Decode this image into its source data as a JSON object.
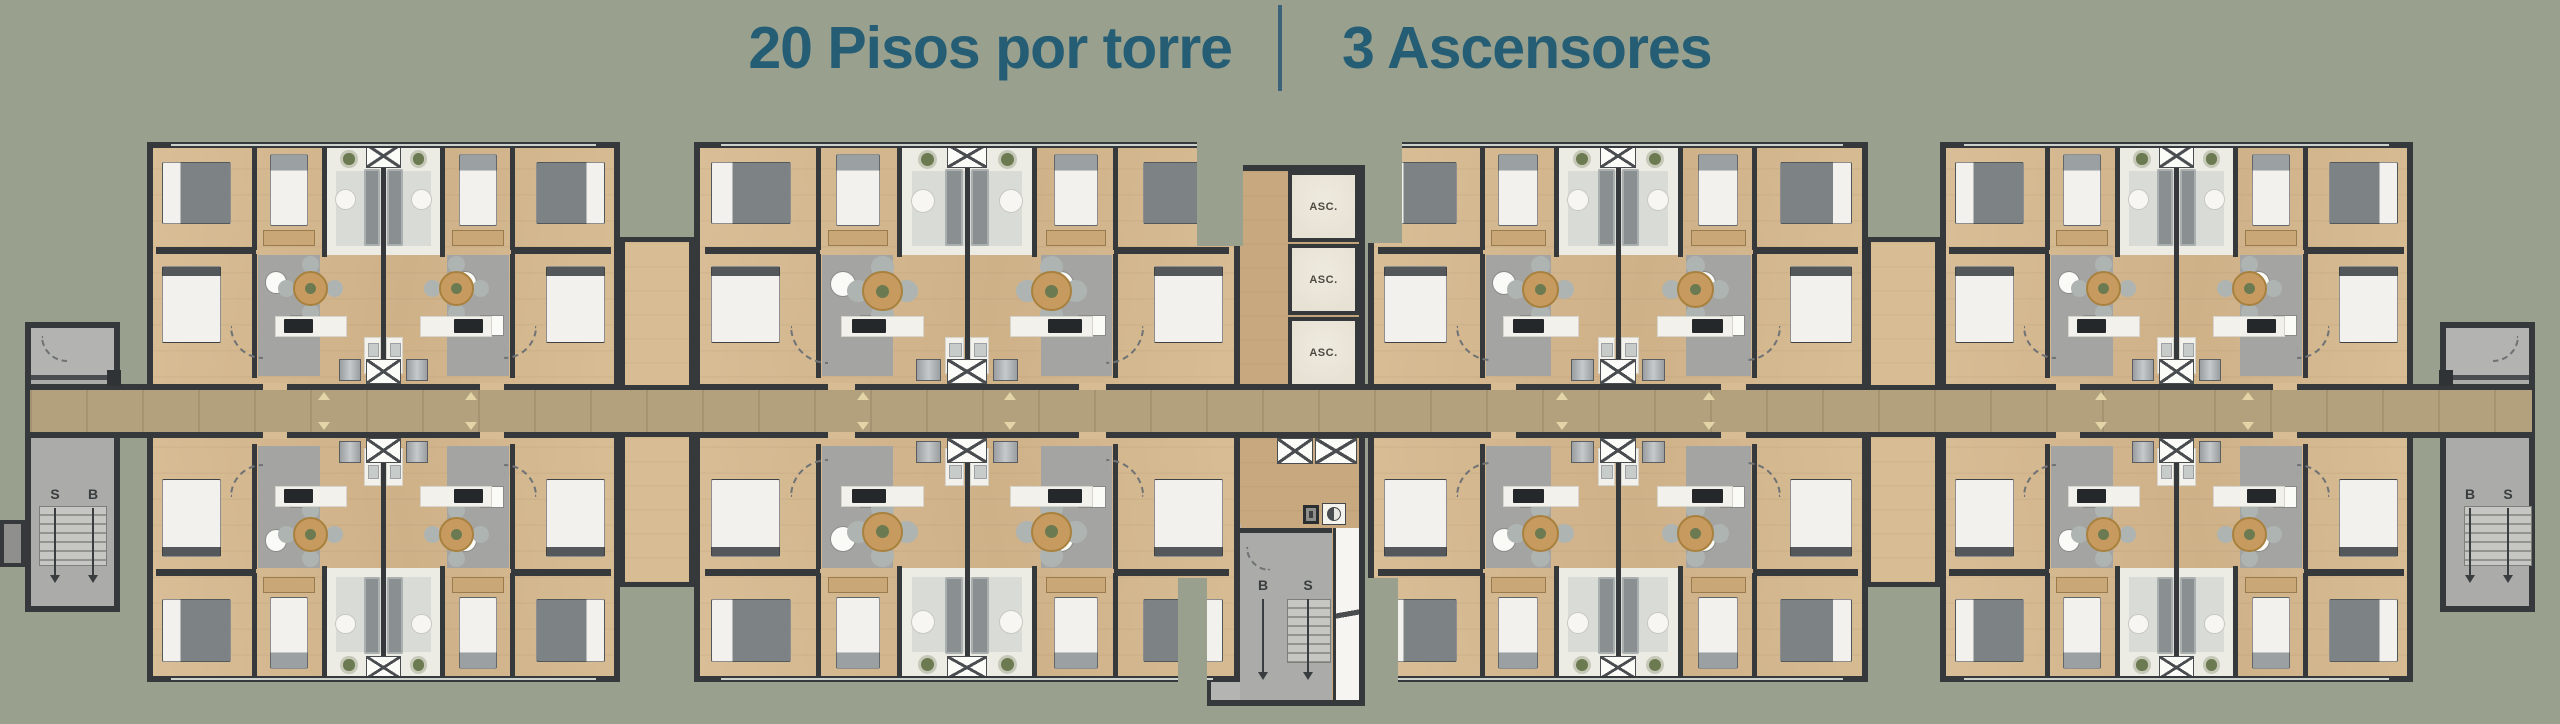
{
  "header": {
    "floors_label": "20 Pisos por torre",
    "elevators_label": "3 Ascensores"
  },
  "core": {
    "elevators": [
      {
        "label": "ASC."
      },
      {
        "label": "ASC."
      },
      {
        "label": "ASC."
      }
    ],
    "stair": {
      "left_label": "B",
      "right_label": "S"
    }
  },
  "stairwells": {
    "left": {
      "left_label": "S",
      "right_label": "B"
    },
    "right": {
      "left_label": "B",
      "right_label": "S"
    }
  },
  "colors": {
    "bg": "#99A18E",
    "title": "#255D75",
    "divider": "#3A637A",
    "wall": "#35393B",
    "wood": "#D7BC94",
    "wood_dark": "#C8A87E",
    "corridor": "#B3A07C",
    "white_floor": "#ECEBE4",
    "bath": "#A4A4A2",
    "stair": "#ABABA9",
    "elevator": "#E8E2D5",
    "table": "#C79B5F",
    "marker": "#E3D5A8"
  }
}
